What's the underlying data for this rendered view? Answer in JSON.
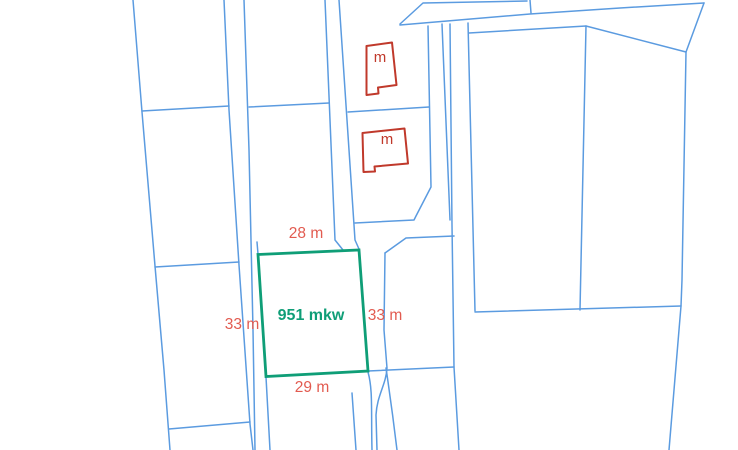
{
  "map": {
    "colors": {
      "background": "#ffffff",
      "parcel_line": "#5b9be0",
      "highlight": "#0f9e77",
      "building": "#c0392b",
      "dimension_text": "#e25b50"
    },
    "parcel_lines": [
      "M133,0 L142,112 L155,266 L164,370 L170,450",
      "M224,0 L229,110 L239,265 L250,424 L253,450",
      "M244,0 L249,150 L253,330 L255,450",
      "M142,111 L229,106",
      "M155,267 L239,262",
      "M169,429 L250,422",
      "M249,107 L329,103",
      "M325,0 L335,240 L343,250",
      "M339,0 L355,240 L359,249",
      "M257,242 L258,254",
      "M266,377 L270,450",
      "M352,393 L356,450",
      "M368,372 C373,390 371,410 372,450",
      "M385,253 L384,330 L387,368 C386,385 377,395 376,415 L377,450",
      "M386,368 C390,395 394,425 397,450",
      "M368,371 L454,367",
      "M385,253 L406,238 L454,236",
      "M428,26 L431,187 L416,216 L414,220 L355,223",
      "M442,24 L450,220",
      "M450,24 L452,225 L454,367 L459,450",
      "M348,112 L429,107",
      "M468,23 L475,311",
      "M469,33 L586,26 L686,52",
      "M586,26 L580,310",
      "M475,312 L681,306",
      "M704,3 L686,52 L682,280 L681,306 L669,450",
      "M400,25 L530,14 L620,8 L704,3",
      "M400,24 L423,3 L527,1",
      "M530,0 L531,13"
    ],
    "highlight_plot": {
      "points": "258,254.5 359,250 368,371 266,376.5",
      "area_label": "951 mkw",
      "label_x": 311,
      "label_y": 316
    },
    "buildings": [
      {
        "points": "366.5,46 392,42.5 396.5,85 378,87.5 378.5,93.5 366.5,95",
        "label": "m",
        "label_x": 380,
        "label_y": 58
      },
      {
        "points": "362.5,133 404.5,128.5 408,163.5 374.5,166.5 375,171.5 363.5,172",
        "label": "m",
        "label_x": 387,
        "label_y": 140
      }
    ],
    "dimensions": [
      {
        "text": "28 m",
        "x": 306,
        "y": 234
      },
      {
        "text": "33 m",
        "x": 242,
        "y": 325
      },
      {
        "text": "33 m",
        "x": 385,
        "y": 316
      },
      {
        "text": "29 m",
        "x": 312,
        "y": 388
      }
    ]
  }
}
